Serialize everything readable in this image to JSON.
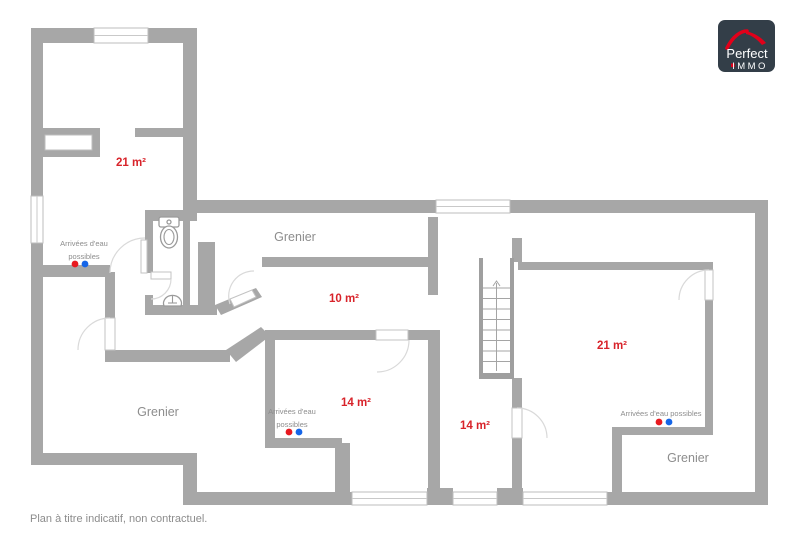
{
  "logo": {
    "brand": "Perfect",
    "suffix": "IMMO"
  },
  "footer": {
    "note": "Plan à titre indicatif, non contractuel."
  },
  "rooms": [
    {
      "name": "room-21-top-left",
      "label": "21 m²"
    },
    {
      "name": "grenier-top",
      "label": "Grenier"
    },
    {
      "name": "room-10",
      "label": "10 m²"
    },
    {
      "name": "grenier-bottom-left",
      "label": "Grenier"
    },
    {
      "name": "room-14-left",
      "label": "14 m²"
    },
    {
      "name": "room-14-center",
      "label": "14 m²"
    },
    {
      "name": "room-21-right",
      "label": "21 m²"
    },
    {
      "name": "grenier-bottom-right",
      "label": "Grenier"
    }
  ],
  "water_supply_labels": {
    "top_left": {
      "line1": "Arrivées d'eau",
      "line2": "possibles"
    },
    "bottom_left": {
      "line1": "Arrivées d'eau",
      "line2": "possibles"
    },
    "bottom_right": {
      "line": "Arrivées d'eau possibles"
    }
  },
  "colors": {
    "wall": "#a7a7a7",
    "area_label": "#d8232a",
    "room_label": "#8d8d8d",
    "hot_water_dot": "#e8191f",
    "cold_water_dot": "#1565e8",
    "logo_background": "#333e48",
    "logo_red": "#e2001a"
  }
}
